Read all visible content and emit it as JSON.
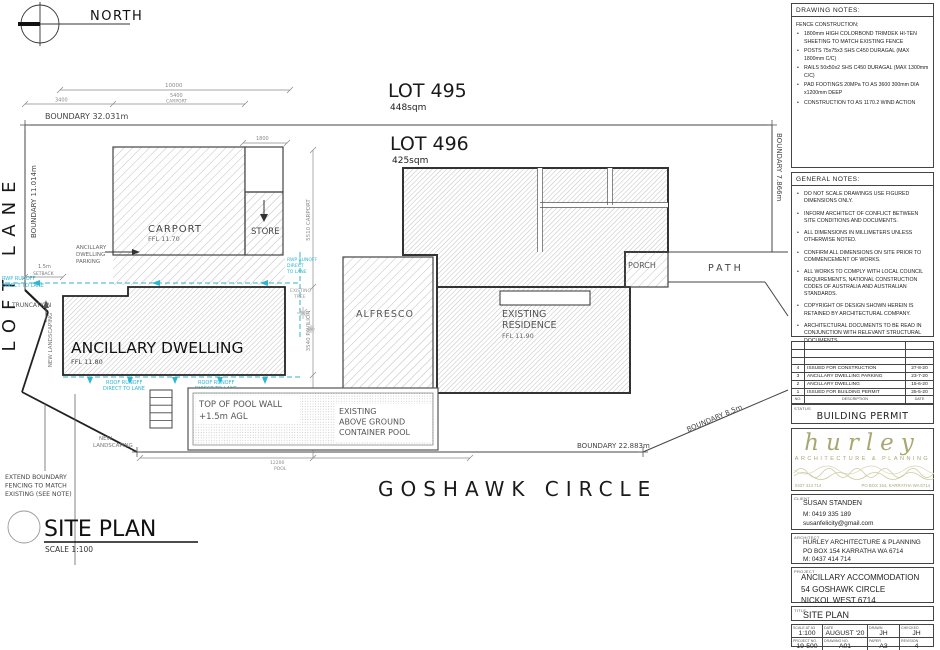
{
  "plan": {
    "north": "NORTH",
    "lot495": {
      "name": "LOT 495",
      "area": "448sqm"
    },
    "lot496": {
      "name": "LOT 496",
      "area": "425sqm"
    },
    "street": "GOSHAWK CIRCLE",
    "lane": "LOFT LANE",
    "boundary": {
      "top": "BOUNDARY 32.031m",
      "left": "BOUNDARY 11.014m",
      "right": "BOUNDARY 7.866m",
      "bottom": "BOUNDARY 22.883m",
      "diag": "BOUNDARY 8.5m"
    },
    "carport": {
      "name": "CARPORT",
      "ffl": "FFL 11.70"
    },
    "store": "STORE",
    "dwelling": {
      "name": "ANCILLARY DWELLING",
      "ffl": "FFL 11.80"
    },
    "alfresco": "ALFRESCO",
    "residence": {
      "l1": "EXISTING",
      "l2": "RESIDENCE",
      "ffl": "FFL 11.90"
    },
    "porch": "PORCH",
    "path": "PATH",
    "pool": {
      "w1": "TOP OF POOL WALL",
      "w2": "+1.5m AGL",
      "e1": "EXISTING",
      "e2": "ABOVE GROUND",
      "e3": "CONTAINER POOL"
    },
    "ann": {
      "rwp1a": "RWP RUNOFF",
      "rwp1b": "DIRECT TO LANE",
      "rwp2a": "RWP RUNOFF",
      "rwp2b": "DIRECT",
      "rwp2c": "TO LANE",
      "roof1a": "ROOF RUNOFF",
      "roof1b": "DIRECT TO LANE",
      "roof2a": "ROOF RUNOFF",
      "roof2b": "DIRECT TO LANE",
      "truncation": "TRUNCATION",
      "parka": "ANCILLARY",
      "parkb": "DWELLING",
      "parkc": "PARKING",
      "setback1": "1.5m",
      "setback2": "SETBACK",
      "landscape1": "NEW LANDSCAPING",
      "landscape2a": "NEW",
      "landscape2b": "LANDSCAPING",
      "extend1": "EXTEND BOUNDARY",
      "extend2": "FENCING TO MATCH",
      "extend3": "EXISTING (SEE NOTE)",
      "tree1": "EXISTING",
      "tree2": "TREE"
    },
    "dims": {
      "d1": "10000",
      "d2": "3400",
      "d3": "5400",
      "d3w": "CARPORT",
      "d4": "1800",
      "d5": "5510 CARPORT",
      "d6": "3540 PAVILION",
      "d7": "3415",
      "d8": "12200",
      "d8w": "POOL"
    },
    "drawing_title": {
      "name": "SITE PLAN",
      "scale": "SCALE 1:100"
    }
  },
  "titleblock": {
    "drawing_notes": {
      "header": "DRAWING NOTES:",
      "intro": "FENCE CONSTRUCTION;",
      "items": [
        "1800mm HIGH COLORBOND TRIMDEK HI-TEN SHEETING TO MATCH EXISTING FENCE",
        "POSTS 75x75x3 SHS C450 DURAGAL (MAX 1800mm C/C)",
        "RAILS 50x50x2 SHS C450 DURAGAL (MAX 1300mm C/C)",
        "PAD FOOTINGS 20MPa TO AS 3600 300mm DIA x1200mm DEEP",
        "CONSTRUCTION TO AS 1170.2 WIND ACTION"
      ]
    },
    "general_notes": {
      "header": "GENERAL NOTES:",
      "items": [
        "DO NOT SCALE DRAWINGS USE FIGURED DIMENSIONS ONLY.",
        "INFORM ARCHITECT OF CONFLICT BETWEEN SITE CONDITIONS AND DOCUMENTS.",
        "ALL DIMENSIONS IN MILLIMETERS UNLESS OTHERWISE NOTED.",
        "CONFIRM ALL DIMENSIONS ON SITE PRIOR TO COMMENCEMENT OF WORKS.",
        "ALL WORKS TO COMPLY WITH LOCAL COUNCIL REQUIREMENTS, NATIONAL CONSTRUCTION CODES OF AUSTRALIA AND AUSTRALIAN STANDARDS.",
        "COPYRIGHT OF DESIGN SHOWN HEREIN IS RETAINED BY ARCHITECTURAL COMPANY.",
        "ARCHITECTURAL DOCUMENTS TO BE READ IN CONJUNCTION WITH RELEVANT STRUCTURAL DOCUMENTS."
      ]
    },
    "revisions": {
      "rows": [
        {
          "no": "",
          "desc": "",
          "date": ""
        },
        {
          "no": "",
          "desc": "",
          "date": ""
        },
        {
          "no": "",
          "desc": "",
          "date": ""
        },
        {
          "no": "4",
          "desc": "ISSUED FOR CONSTRUCTION",
          "date": "27-8-20"
        },
        {
          "no": "3",
          "desc": "ANCILLARY DWELLING PARKING",
          "date": "23-7-20"
        },
        {
          "no": "2",
          "desc": "ANCILLARY DWELLING",
          "date": "15-6-20"
        },
        {
          "no": "1",
          "desc": "ISSUED FOR BUILDING PERMIT",
          "date": "25-5-20"
        }
      ],
      "head": {
        "no": "NO.",
        "desc": "DESCRIPTION",
        "date": "DATE"
      }
    },
    "status": {
      "label": "STATUS",
      "value": "BUILDING PERMIT"
    },
    "logo": {
      "name": "hurley",
      "tagline": "ARCHITECTURE & PLANNING",
      "phone": "0437 414 714",
      "address": "PO BOX 154, KARRATHA WA 6714"
    },
    "client": {
      "label": "CLIENT",
      "name": "SUSAN STANDEN",
      "phone": "M: 0419 335 189",
      "email": "susanfelicity@gmail.com"
    },
    "architect": {
      "label": "ARCHITECT",
      "name": "HURLEY ARCHITECTURE & PLANNING",
      "address": "PO BOX 154 KARRATHA WA 6714",
      "phone": "M: 0437 414 714"
    },
    "project": {
      "label": "PROJECT",
      "name": "ANCILLARY ACCOMMODATION",
      "addr1": "54 GOSHAWK CIRCLE",
      "addr2": "NICKOL WEST  6714"
    },
    "sheet": {
      "label": "TITLE",
      "value": "SITE PLAN"
    },
    "fields": {
      "scale": {
        "label": "SCALE AT A3",
        "value": "1:100"
      },
      "date": {
        "label": "DATE",
        "value": "AUGUST '20"
      },
      "drawn": {
        "label": "DRAWN",
        "value": "JH"
      },
      "checked": {
        "label": "CHECKED",
        "value": "JH"
      },
      "project_no": {
        "label": "PROJECT NO.",
        "value": "19-500"
      },
      "drawing_no": {
        "label": "DRAWING NO.",
        "value": "A01"
      },
      "paper": {
        "label": "PAPER",
        "value": "A3"
      },
      "revision": {
        "label": "REVISION",
        "value": "4"
      }
    }
  }
}
